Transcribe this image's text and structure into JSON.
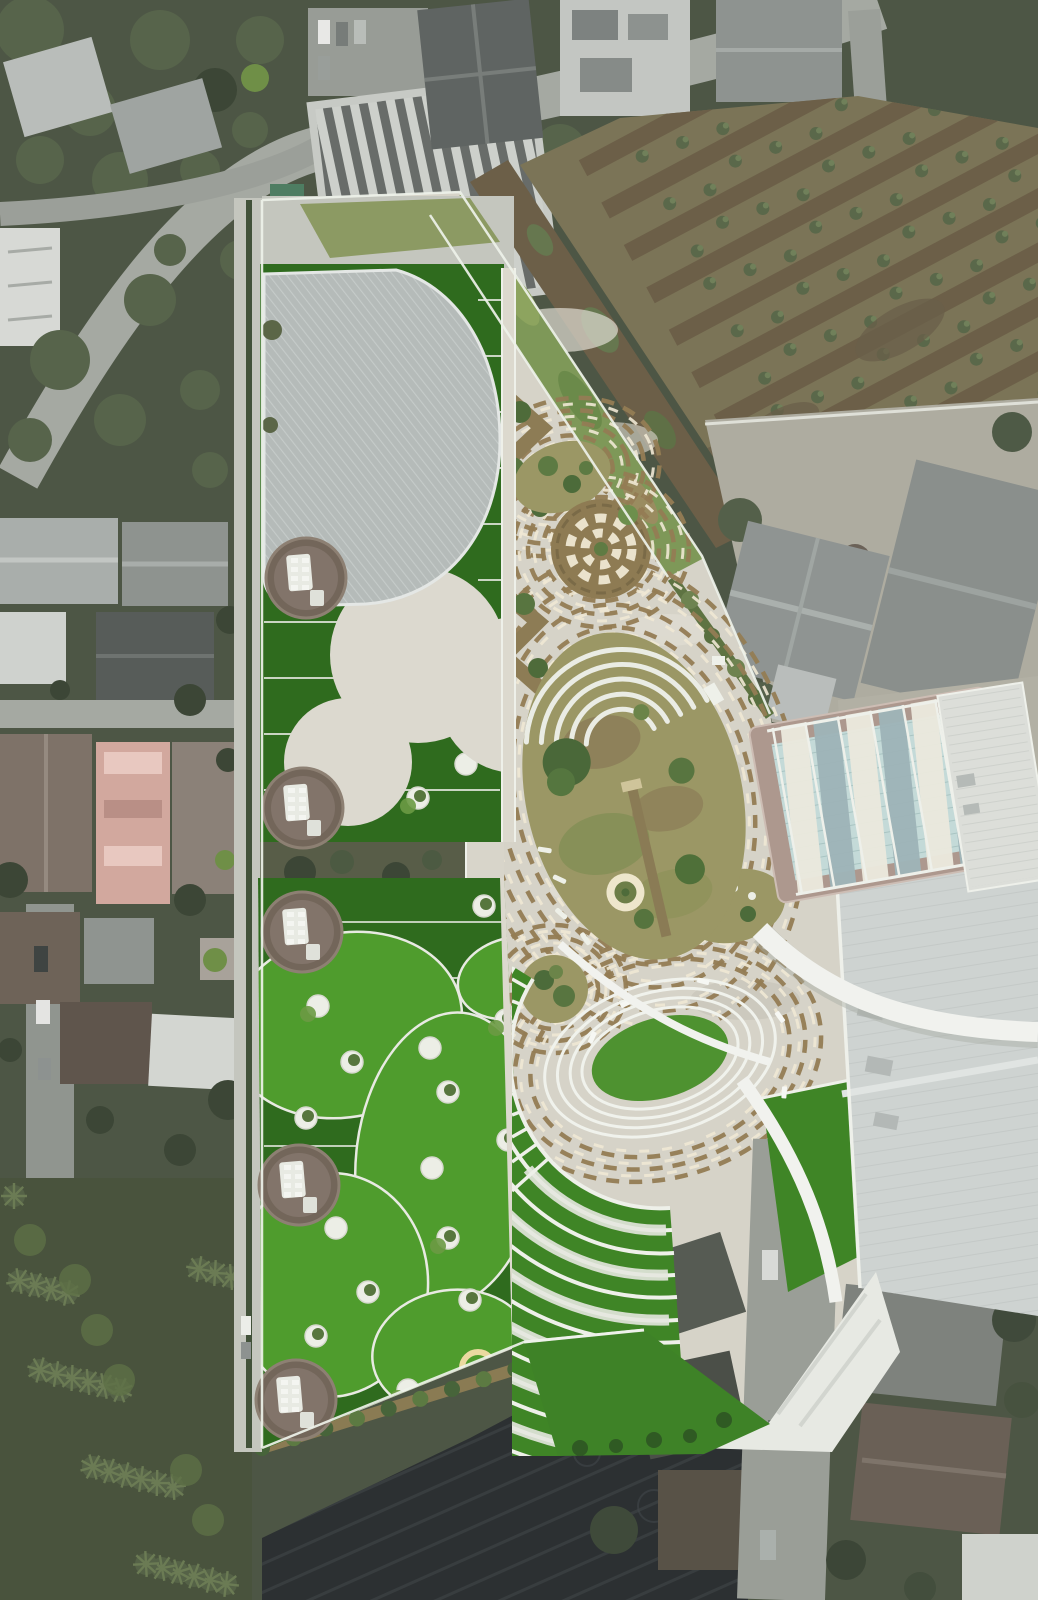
{
  "scene": {
    "type": "aerial-drone-photograph",
    "orientation": "top-down nadir view",
    "subject": "Landscaped park and school campus with a large curved grey ribbed roof, rooftop turf with white circles, circular pavilions, a concrete plaza with brown dashed concentric ring patterns, an olive oval garden with white crescent benches, a fan of white amphitheater terraces around a sunken green oval, a shaded swimming pool, and a large gymnasium roof, surrounded by desaturated residential houses, a canal-irrigated palm plantation and a dark netted farm field",
    "style": "park rendered in saturated greens while surroundings are desaturated grey-green"
  },
  "regions": [
    {
      "name": "curved-roof-building",
      "desc": "grey D-shaped ribbed roof on turf slab, north-west"
    },
    {
      "name": "rooftop-turf-wings",
      "desc": "artificial turf with bright oval lawns, white planters and circular pavilions"
    },
    {
      "name": "central-plaza",
      "desc": "pale concrete with concentric brown dashed ellipse patterns and checker spiral garden"
    },
    {
      "name": "oval-garden",
      "desc": "olive grass oval with five nested white crescent benches and central path"
    },
    {
      "name": "amphitheater-fan",
      "desc": "white terraced steps with green treads radiating around sunken oval lawn"
    },
    {
      "name": "sunken-lawn",
      "desc": "green oval with concentric white ring steps"
    },
    {
      "name": "swimming-pool",
      "desc": "pale blue pool under alternating white and grey shade sails"
    },
    {
      "name": "gymnasium",
      "desc": "large light grey ribbed roof, south-east"
    },
    {
      "name": "canal-plantation",
      "desc": "brown irrigation canals with palm rows, north-east"
    },
    {
      "name": "netted-field",
      "desc": "dark mesh-covered farm field, south"
    },
    {
      "name": "residential-neighborhood",
      "desc": "muted grey roofs, roads and trees on west and north"
    },
    {
      "name": "palm-grove",
      "desc": "muted palm canopy, south-west corner"
    }
  ],
  "palette": {
    "muted_base": "#4d5645",
    "tree_dark": "#3c4636",
    "tree_mid": "#57644b",
    "tree_light": "#6d7f58",
    "road": "#a5a9a2",
    "road_dark": "#90958f",
    "pavement": "#c4c6be",
    "plaza": "#d6d3c8",
    "plaza_bright": "#e0ddd3",
    "dash_brown": "#937c54",
    "dash_cream": "#efe8d4",
    "turf_dark": "#2f6b1e",
    "turf_mid": "#3f8526",
    "turf_bright": "#4f9c2d",
    "white_line": "#eef0e9",
    "concrete_circle": "#dcd9cf",
    "amphi_green": "#4e9230",
    "olive": "#9b9765",
    "soil": "#8b7c59",
    "bush": "#5f7b43",
    "hedge": "#42523a",
    "canal": "#6c5f48",
    "plantation": "#7b7457",
    "field_dark": "#2c3032",
    "field_stripe": "#3a3f41",
    "roof_d": "#b5bbb9",
    "roof_rib": "#c7cdcb",
    "gym_roof": "#ced3d1",
    "canopy": "#f1f2ee",
    "pool_deck": "#ad988e",
    "pool_water": "#c4dad8",
    "sail_gray": "#9eb4b8",
    "sail_white": "#eae8dd",
    "pavilion": "#73665a",
    "pavilion_light": "#82746a",
    "grove": "#49533d",
    "north_strip": "#7e9858"
  }
}
